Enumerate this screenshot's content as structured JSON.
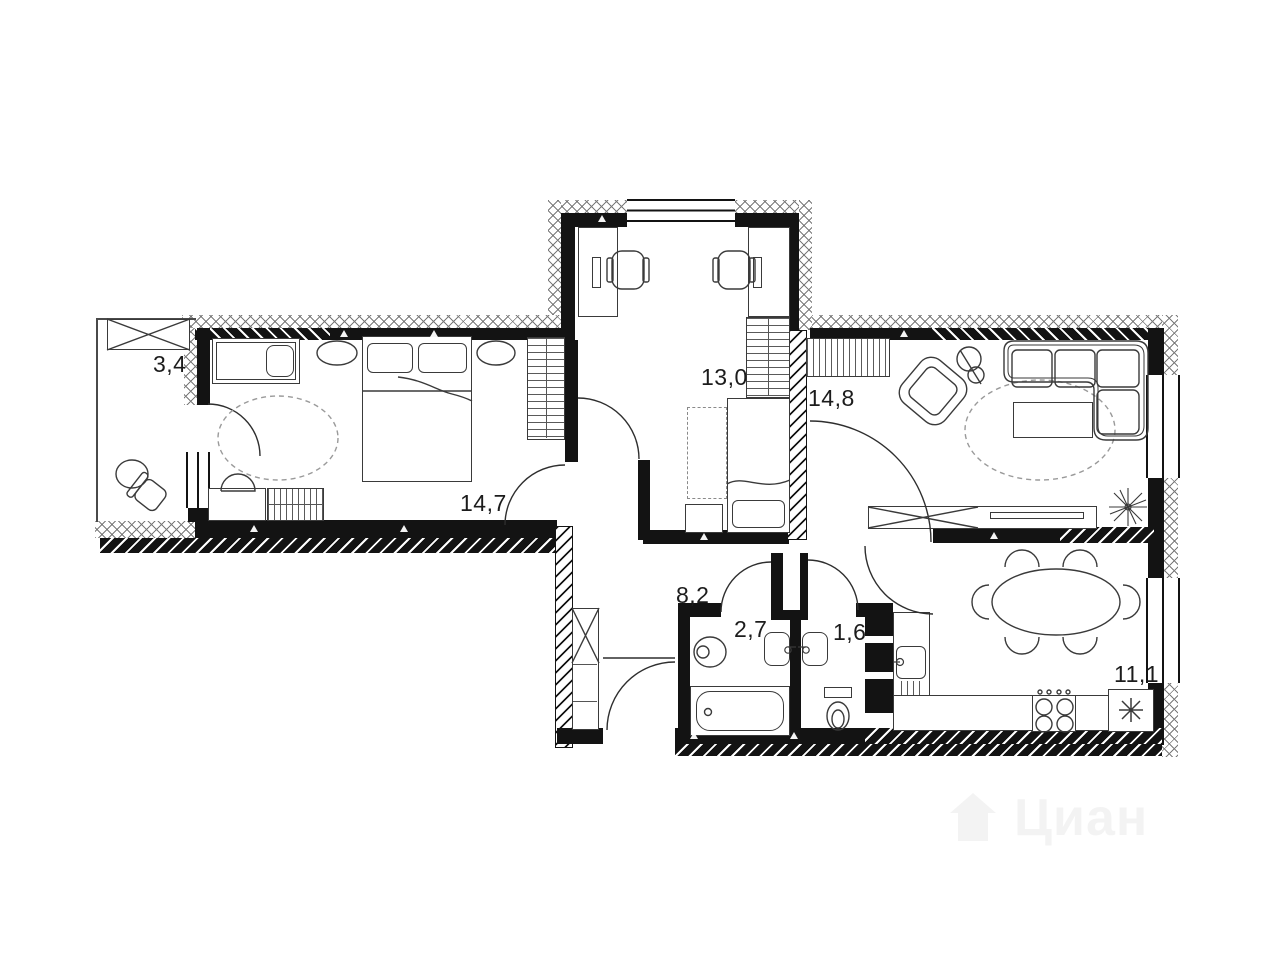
{
  "rooms": [
    {
      "key": "loggia",
      "area_label": "3,4"
    },
    {
      "key": "bedroom",
      "area_label": "14,7"
    },
    {
      "key": "children-room",
      "area_label": "13,0"
    },
    {
      "key": "living-room",
      "area_label": "14,8"
    },
    {
      "key": "hallway",
      "area_label": "8,2"
    },
    {
      "key": "bathroom",
      "area_label": "2,7"
    },
    {
      "key": "toilet",
      "area_label": "1,6"
    },
    {
      "key": "kitchen",
      "area_label": "11,1"
    }
  ],
  "watermark": {
    "text": "Циан"
  },
  "colors": {
    "walls": "#131313",
    "furniture_lines": "#3a3a3a",
    "dashed_guides": "#8a8a8a",
    "background": "#ffffff",
    "watermark_gray": "#ededed"
  }
}
